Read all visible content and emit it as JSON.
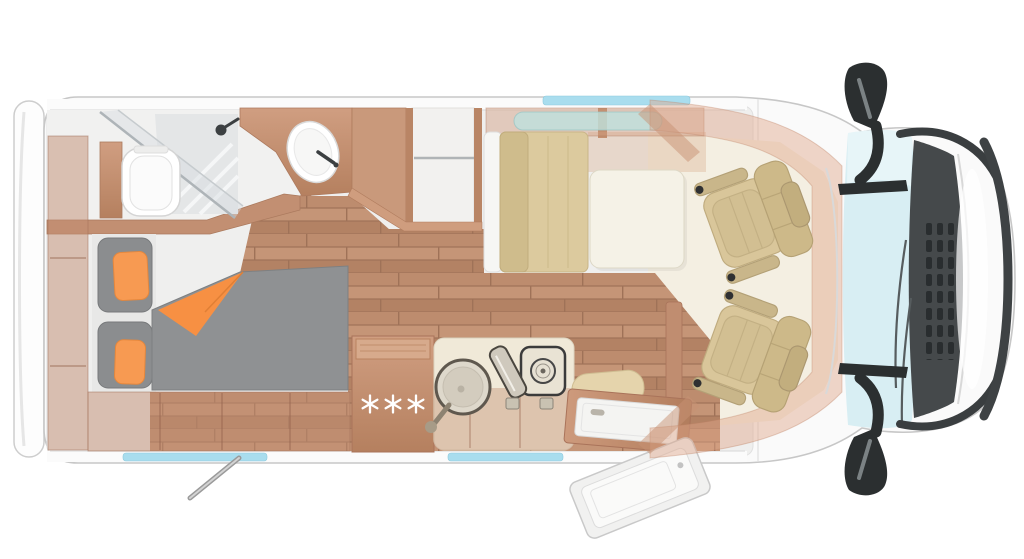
{
  "scene": {
    "title": "Motorhome floor plan - top view",
    "view": "top-down cutaway render",
    "background": "#ffffff"
  },
  "palette": {
    "body_white": "#fafafa",
    "body_outline": "#c7c7c7",
    "interior_base": "#efefee",
    "wood_cabinet": "#c28f72",
    "wood_dark": "#a9735a",
    "floor_plank": "#bd8c6e",
    "mattress_gray": "#8f9193",
    "accent_orange": "#f79a52",
    "seat_beige": "#d9c69a",
    "counter_cream": "#f0e9d8",
    "windshield_glass": "#d8eef3",
    "skylight_cyan": "#a9ddee",
    "trim_dark": "#2b2f30",
    "overcab_peach": "rgba(223,167,138,0.45)"
  },
  "vehicle": {
    "rooms": {
      "bathroom": {
        "name": "Bathroom",
        "features": [
          "toilet",
          "shower cabin",
          "shower head",
          "washbasin",
          "wood vanity"
        ]
      },
      "rear_bedroom": {
        "name": "Rear bedroom",
        "features": [
          "mattress",
          "orange throw blanket",
          "two back cushions",
          "two orange pillows",
          "under-bed storage",
          "rear wardrobe column"
        ]
      },
      "wardrobe": {
        "name": "Wardrobe shelves",
        "features": [
          "hanging rod",
          "open shelf compartment"
        ]
      },
      "kitchen": {
        "name": "Kitchen",
        "fridge_icon": "three-snowflakes",
        "features": [
          "refrigerator",
          "round sink with faucet",
          "hob with open glass lid",
          "burner",
          "two knobs",
          "counter"
        ]
      },
      "dinette": {
        "name": "Dinette",
        "features": [
          "bench seat",
          "table",
          "overhead locker",
          "roof window"
        ]
      },
      "entrance": {
        "name": "Entrance",
        "features": [
          "entry door open",
          "entry step",
          "bench cushion",
          "crank handle"
        ]
      },
      "cab": {
        "name": "Driver cab",
        "features": [
          "driver swivel seat",
          "passenger swivel seat",
          "windshield",
          "cowl vents",
          "wipers",
          "wing mirror top",
          "wing mirror bottom",
          "front bumper"
        ]
      }
    },
    "windows": [
      "roof skylight strip front",
      "rear wall window strip",
      "kitchen wall window strip"
    ]
  }
}
